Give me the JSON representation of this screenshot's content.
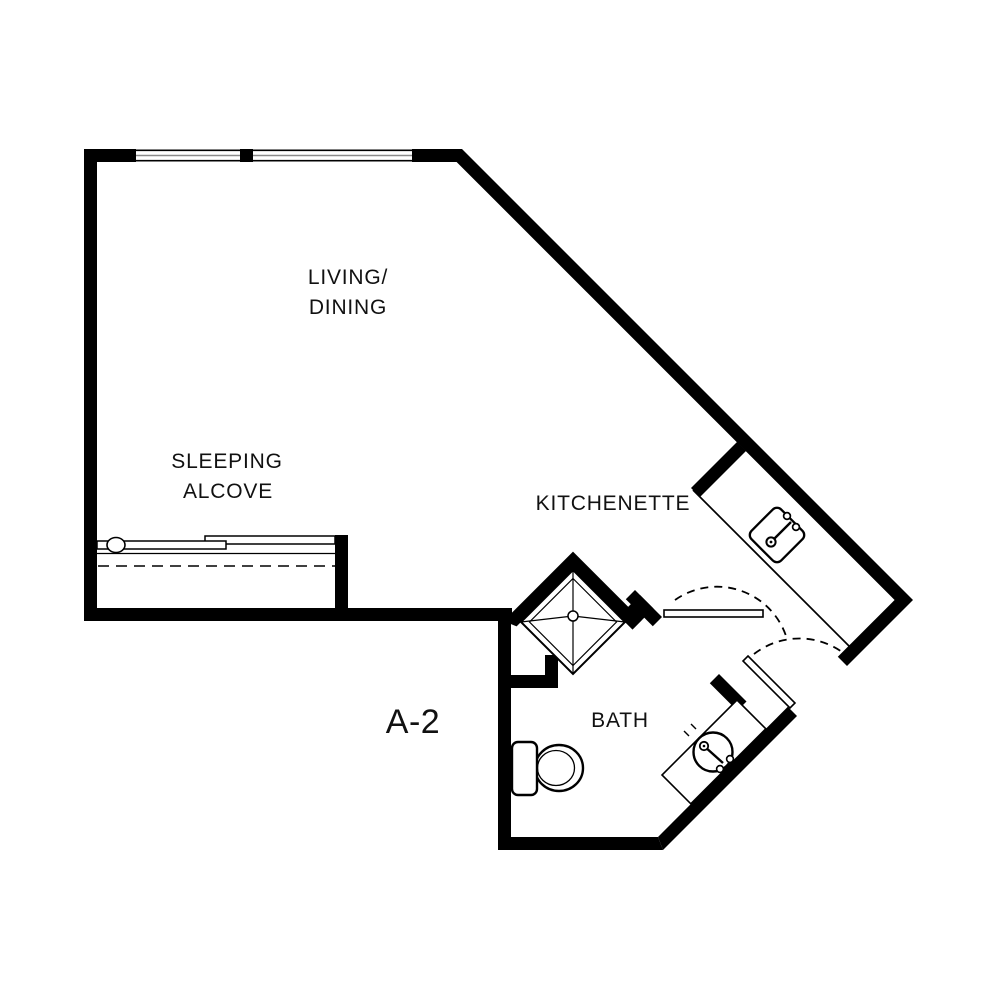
{
  "title": "Unit A-2 floor plan",
  "unit": {
    "id": "A-2"
  },
  "labels": {
    "living_line1": "LIVING/",
    "living_line2": "DINING",
    "sleeping_line1": "SLEEPING",
    "sleeping_line2": "ALCOVE",
    "kitchenette": "KITCHENETTE",
    "bath": "BATH",
    "unit": "A-2"
  },
  "rooms": [
    {
      "name": "Living/Dining"
    },
    {
      "name": "Sleeping Alcove"
    },
    {
      "name": "Kitchenette"
    },
    {
      "name": "Bath"
    }
  ],
  "fixtures": [
    {
      "name": "shower-pan"
    },
    {
      "name": "toilet"
    },
    {
      "name": "vanity-round-sink"
    },
    {
      "name": "kitchen-sink"
    },
    {
      "name": "closet-sliding-doors"
    },
    {
      "name": "entry-door-swing"
    },
    {
      "name": "bath-door-swing"
    },
    {
      "name": "windows",
      "count": 2
    }
  ],
  "colors": {
    "wall": "#000000",
    "background": "#ffffff",
    "line": "#000000",
    "window_mullion": "#8a8a8a",
    "text": "#111111"
  }
}
